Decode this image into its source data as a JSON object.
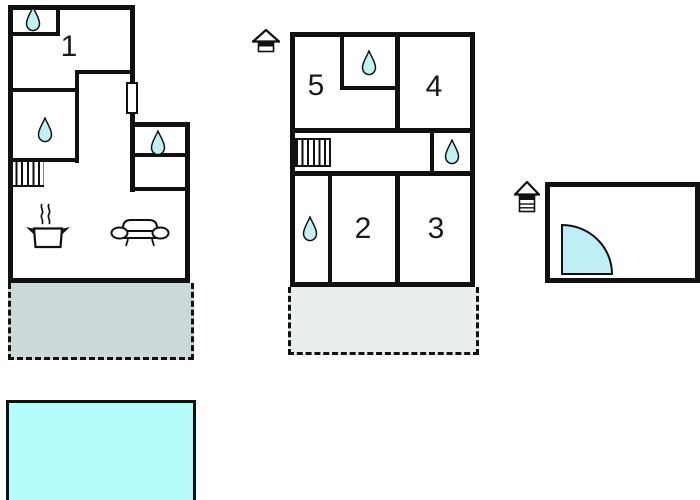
{
  "page": {
    "type": "floor-plan-diagram",
    "background": "#ffffff"
  },
  "rooms": {
    "r1": {
      "label": "1"
    },
    "r2": {
      "label": "2"
    },
    "r3": {
      "label": "3"
    },
    "r4": {
      "label": "4"
    },
    "r5": {
      "label": "5"
    }
  },
  "colors": {
    "wall": "#111111",
    "water": "#c3f1f1",
    "pool": "#b6fbfb",
    "door": "#bfeef5",
    "terrace_left": "#cdd8d8",
    "terrace_middle": "#e8efed"
  },
  "icons": {
    "water-drop-icon": {
      "count": 6
    },
    "entrance-house-icon": {
      "count": 2
    },
    "stairs-icon": {
      "count": 2
    },
    "stove-icon": {
      "count": 1
    },
    "sofa-icon": {
      "count": 1
    },
    "door-swing-icon": {
      "count": 1
    },
    "window-marker": {
      "count": 1
    }
  }
}
